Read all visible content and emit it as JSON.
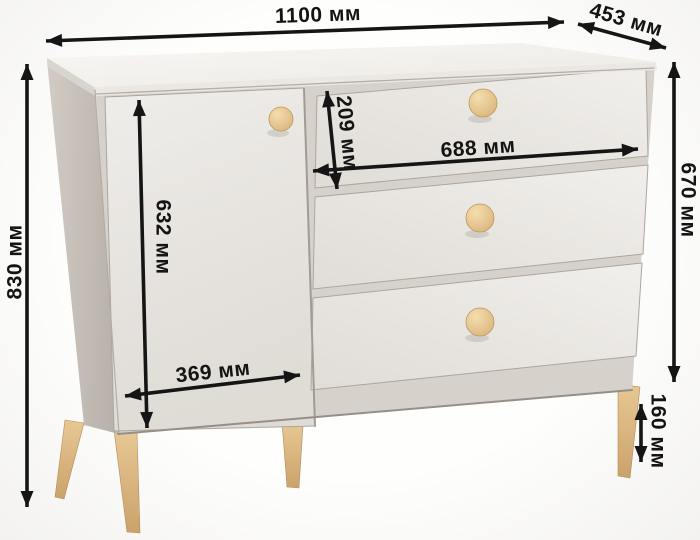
{
  "dimensions": {
    "overall_width": "1100 мм",
    "depth": "453 мм",
    "overall_height": "830 мм",
    "body_height": "670 мм",
    "leg_height": "160 мм",
    "door_height": "632 мм",
    "door_width": "369 мм",
    "top_drawer_height": "209 мм",
    "drawer_front_width": "688 мм"
  },
  "colors": {
    "background": "#fbfbfa",
    "body_front": "#eae7e2",
    "side_panel": "#c6bfb7",
    "carcass_shadow": "#d6d2cb",
    "wood_legs_knobs": "#ddb880",
    "dimension_lines": "#151515"
  }
}
